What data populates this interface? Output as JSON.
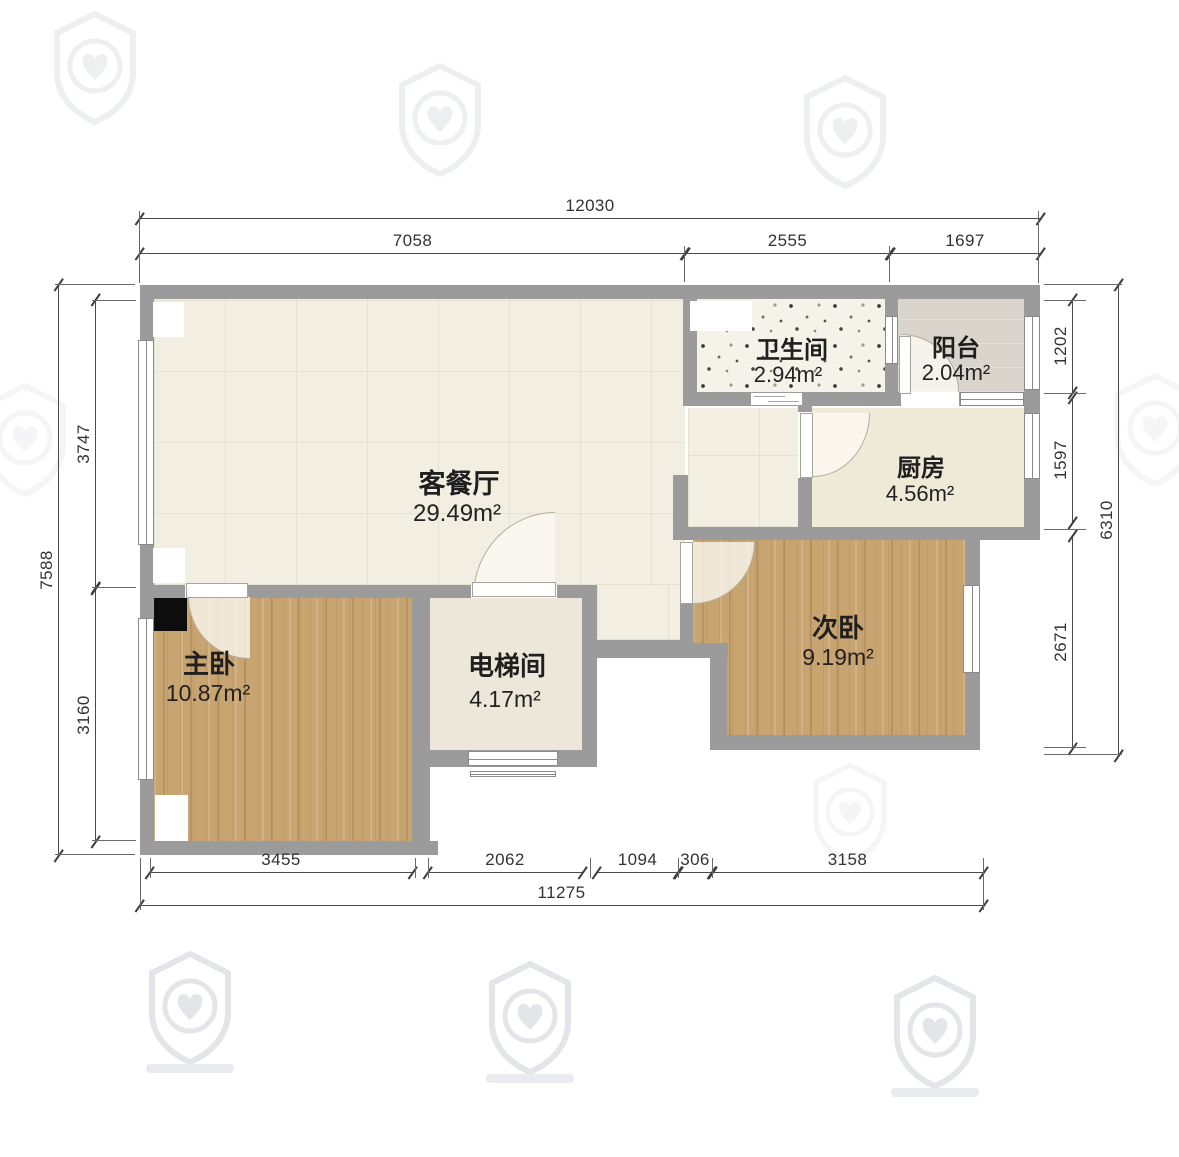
{
  "colors": {
    "wall": "#9b9b9b",
    "wood_floor": "#c8a470",
    "living_floor": "#f2eee1",
    "kitchen_floor": "#efe9d8",
    "elevator_floor": "#ece7d8",
    "balcony_floor": "#d9d5cc",
    "bathroom_floor": "#f5f2ea",
    "column": "#0d0d0d",
    "dimension_text": "#333333",
    "label_text": "#1f1f1f"
  },
  "rooms": {
    "living": {
      "name": "客餐厅",
      "area": "29.49m²"
    },
    "bathroom": {
      "name": "卫生间",
      "area": "2.94m²"
    },
    "balcony": {
      "name": "阳台",
      "area": "2.04m²"
    },
    "kitchen": {
      "name": "厨房",
      "area": "4.56m²"
    },
    "second_bedroom": {
      "name": "次卧",
      "area": "9.19m²"
    },
    "master_bedroom": {
      "name": "主卧",
      "area": "10.87m²"
    },
    "elevator": {
      "name": "电梯间",
      "area": "4.17m²"
    }
  },
  "dimensions": {
    "top": {
      "total": "12030",
      "segments": [
        "7058",
        "2555",
        "1697"
      ]
    },
    "bottom": {
      "total": "11275",
      "segments": [
        "3455",
        "2062",
        "1094",
        "306",
        "3158"
      ]
    },
    "left": {
      "total": "7588",
      "segments": [
        "3747",
        "3160"
      ]
    },
    "right": {
      "total": "6310",
      "segments": [
        "1202",
        "1597",
        "2671"
      ]
    }
  }
}
